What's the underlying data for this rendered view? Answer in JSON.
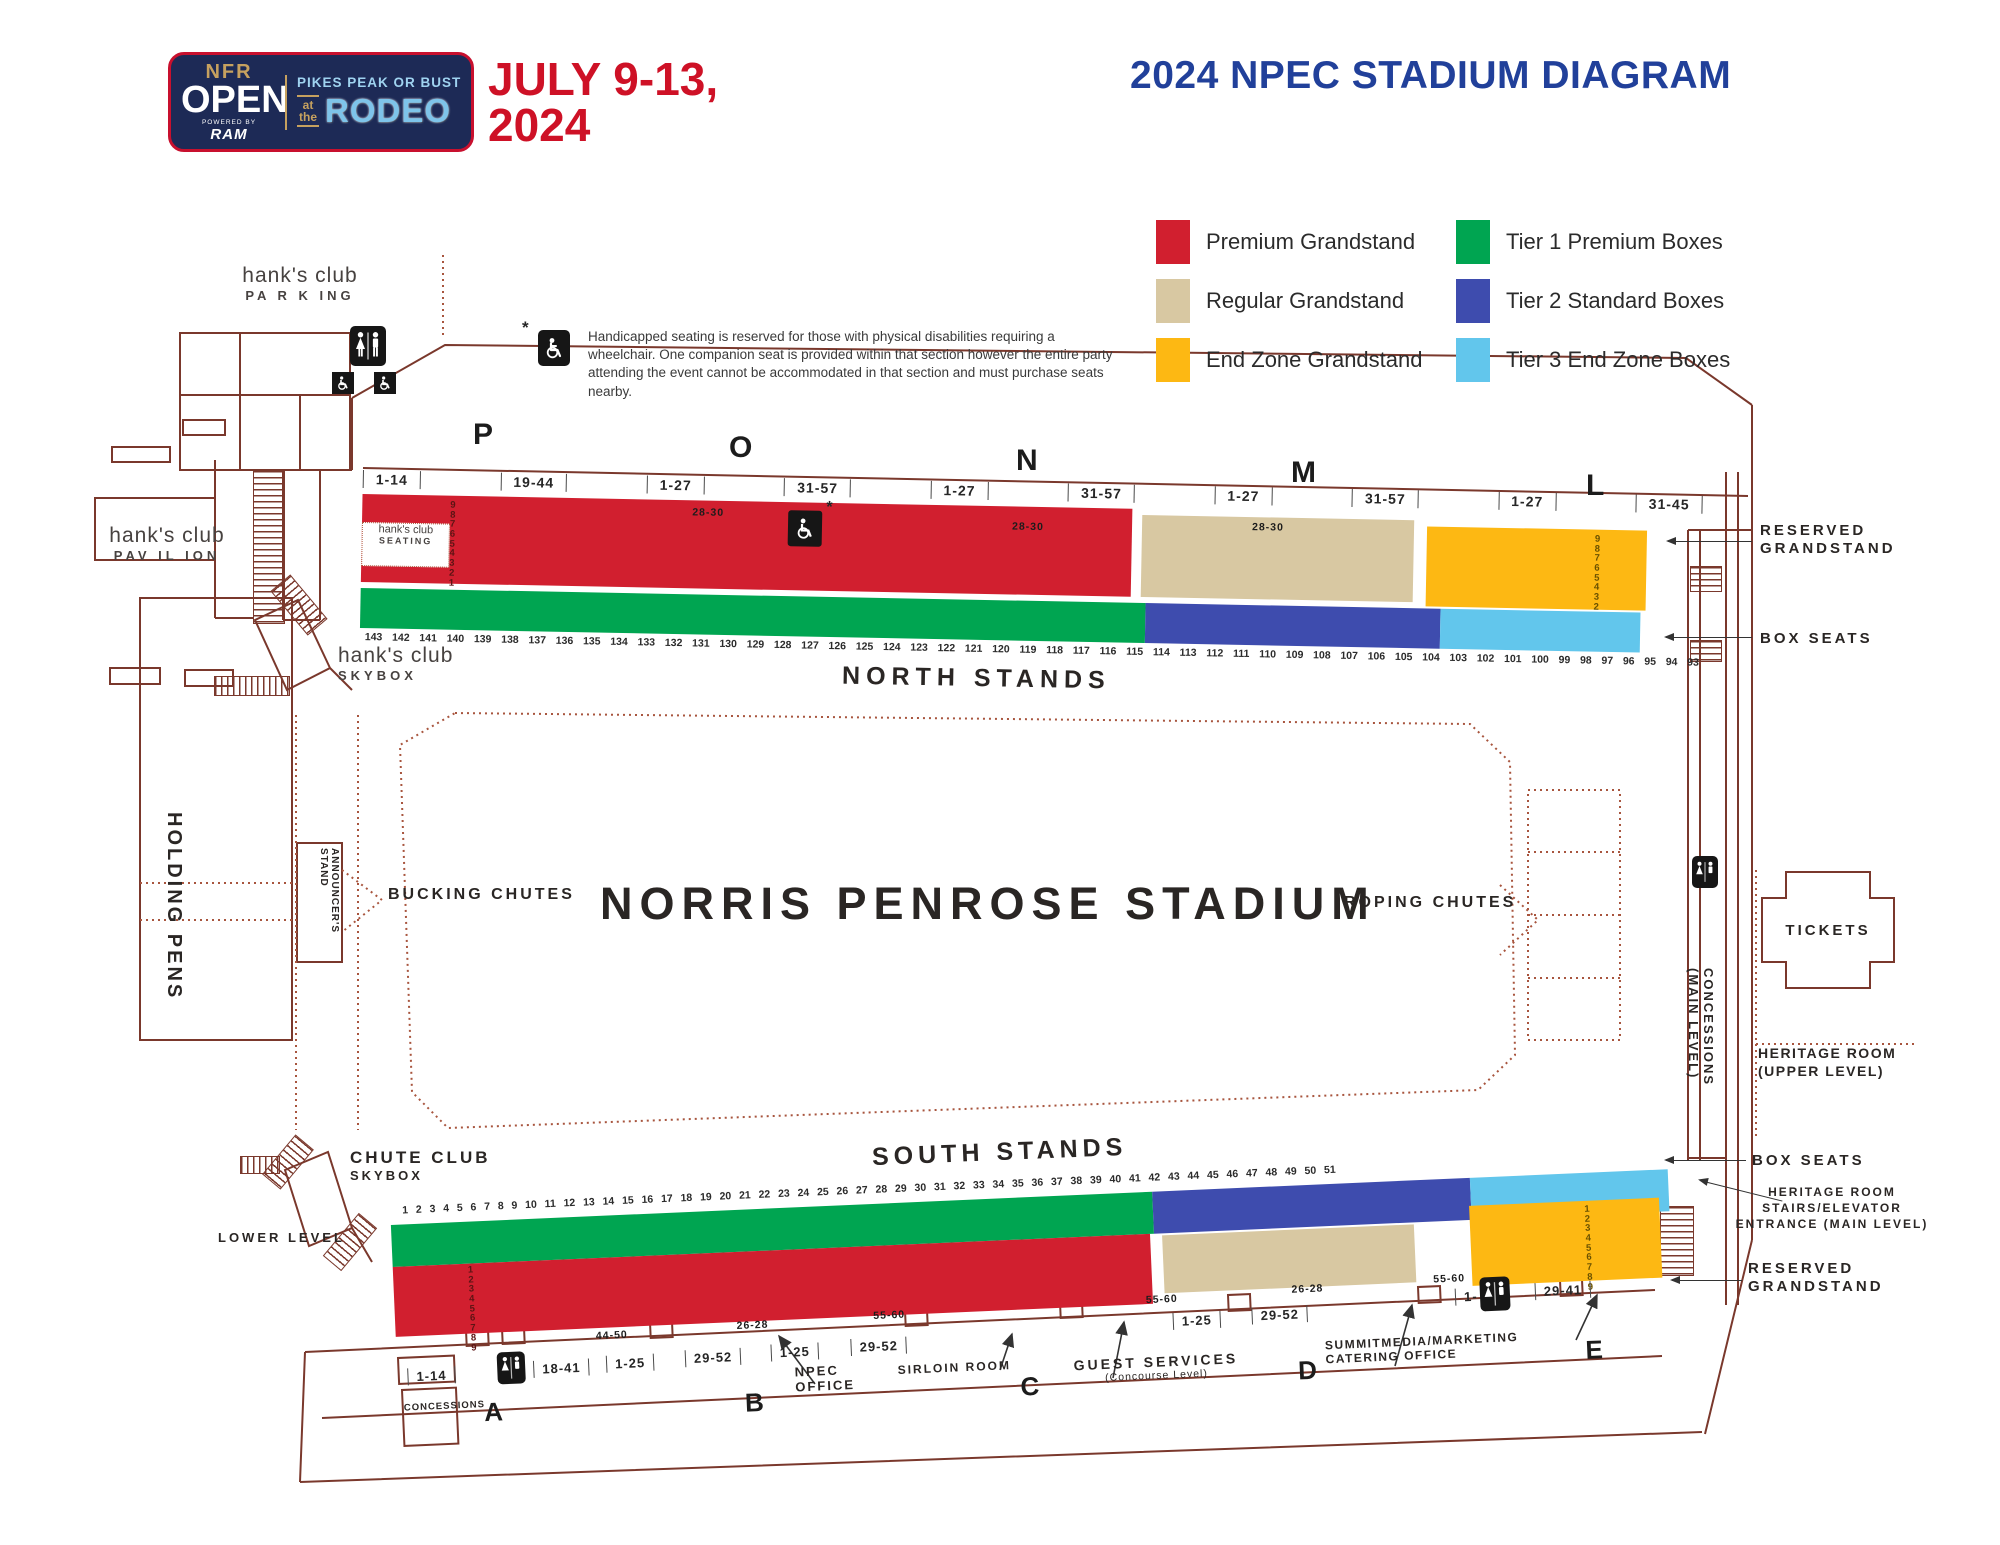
{
  "header": {
    "logo": {
      "nfr": "NFR",
      "open": "OPEN",
      "powered_by": "POWERED BY",
      "ram": "RAM",
      "tagline": "PIKES PEAK OR BUST",
      "at_the": "at\nthe",
      "rodeo": "RODEO"
    },
    "dates_line1": "JULY 9-13,",
    "dates_line2": "2024",
    "title": "2024 NPEC STADIUM DIAGRAM"
  },
  "legend": {
    "items": [
      {
        "label": "Premium Grandstand",
        "color": "#d11f2f"
      },
      {
        "label": "Regular Grandstand",
        "color": "#d8c8a2"
      },
      {
        "label": "End Zone Grandstand",
        "color": "#fdb813"
      },
      {
        "label": "Tier 1 Premium Boxes",
        "color": "#00a551"
      },
      {
        "label": "Tier 2 Standard Boxes",
        "color": "#3e4cae"
      },
      {
        "label": "Tier 3 End Zone Boxes",
        "color": "#62c6ec"
      }
    ]
  },
  "note": {
    "marker": "*",
    "text": "Handicapped seating is reserved for those with physical disabilities requiring a wheelchair. One companion seat is provided within that section however the entire party attending the event cannot be accommodated in that section and must purchase seats nearby."
  },
  "west": {
    "parking_name": "hank's club",
    "parking_sub": "PA R K ING",
    "pavilion_name": "hank's club",
    "pavilion_sub": "PAV IL ION",
    "skybox_name": "hank's club",
    "skybox_sub": "SKYBOX"
  },
  "north": {
    "letters": [
      "P",
      "O",
      "N",
      "M",
      "L"
    ],
    "ranges": [
      "1-14",
      "19-44",
      "1-27",
      "31-57",
      "1-27",
      "31-57",
      "1-27",
      "31-57",
      "1-27",
      "31-45"
    ],
    "seating_name": "hank's club",
    "seating_sub": "SEATING",
    "red_rows": "987654321",
    "red_door1": "28-30",
    "red_door2": "28-30",
    "tan_door": "28-30",
    "gold_rows": "987654321",
    "handicap_marker": "*",
    "numbers": [
      "143",
      "142",
      "141",
      "140",
      "139",
      "138",
      "137",
      "136",
      "135",
      "134",
      "133",
      "132",
      "131",
      "130",
      "129",
      "128",
      "127",
      "126",
      "125",
      "124",
      "123",
      "122",
      "121",
      "120",
      "119",
      "118",
      "117",
      "116",
      "115",
      "114",
      "113",
      "112",
      "111",
      "110",
      "109",
      "108",
      "107",
      "106",
      "105",
      "104",
      "103",
      "102",
      "101",
      "100",
      "99",
      "98",
      "97",
      "96",
      "95",
      "94",
      "93"
    ],
    "label": "NORTH STANDS",
    "reserved": "RESERVED GRANDSTAND",
    "box_seats": "BOX SEATS"
  },
  "center": {
    "holding_pens": "HOLDING PENS",
    "announcers": "ANNOUNCER'S STAND",
    "bucking": "BUCKING CHUTES",
    "stadium": "NORRIS PENROSE STADIUM",
    "roping": "ROPING CHUTES"
  },
  "east": {
    "tickets": "TICKETS",
    "concessions": "CONCESSIONS\n(MAIN LEVEL)",
    "heritage_upper": "HERITAGE ROOM    (UPPER LEVEL)",
    "box_seats_south": "BOX SEATS",
    "heritage_stairs": "HERITAGE ROOM STAIRS/ELEVATOR ENTRANCE (MAIN LEVEL)",
    "reserved_south": "RESERVED GRANDSTAND"
  },
  "south": {
    "label": "SOUTH STANDS",
    "numbers": [
      "1",
      "2",
      "3",
      "4",
      "5",
      "6",
      "7",
      "8",
      "9",
      "10",
      "11",
      "12",
      "13",
      "14",
      "15",
      "16",
      "17",
      "18",
      "19",
      "20",
      "21",
      "22",
      "23",
      "24",
      "25",
      "26",
      "27",
      "28",
      "29",
      "30",
      "31",
      "32",
      "33",
      "34",
      "35",
      "36",
      "37",
      "38",
      "39",
      "40",
      "41",
      "42",
      "43",
      "44",
      "45",
      "46",
      "47",
      "48",
      "49",
      "50",
      "51"
    ],
    "red_rows": "123456789",
    "gold_rows": "123456789",
    "door_labels": [
      "44-50",
      "26-28",
      "55-60",
      "55-60",
      "26-28",
      "55-60"
    ],
    "ranges": [
      "1-14",
      "18-41",
      "1-25",
      "29-52",
      "1-25",
      "29-52",
      "1-25",
      "29-52",
      "1-",
      "29-41"
    ],
    "letters": [
      "A",
      "B",
      "C",
      "D",
      "E"
    ],
    "concessions": "CONCESSIONS",
    "npec_office": "NPEC\nOFFICE",
    "sirloin": "SIRLOIN ROOM",
    "guest": "GUEST SERVICES",
    "guest_sub": "(Concourse Level)",
    "summit": "SUMMITMEDIA/MARKETING",
    "catering": "CATERING OFFICE",
    "chute_name": "CHUTE CLUB",
    "chute_sub": "SKYBOX",
    "lower_level": "LOWER LEVEL"
  }
}
